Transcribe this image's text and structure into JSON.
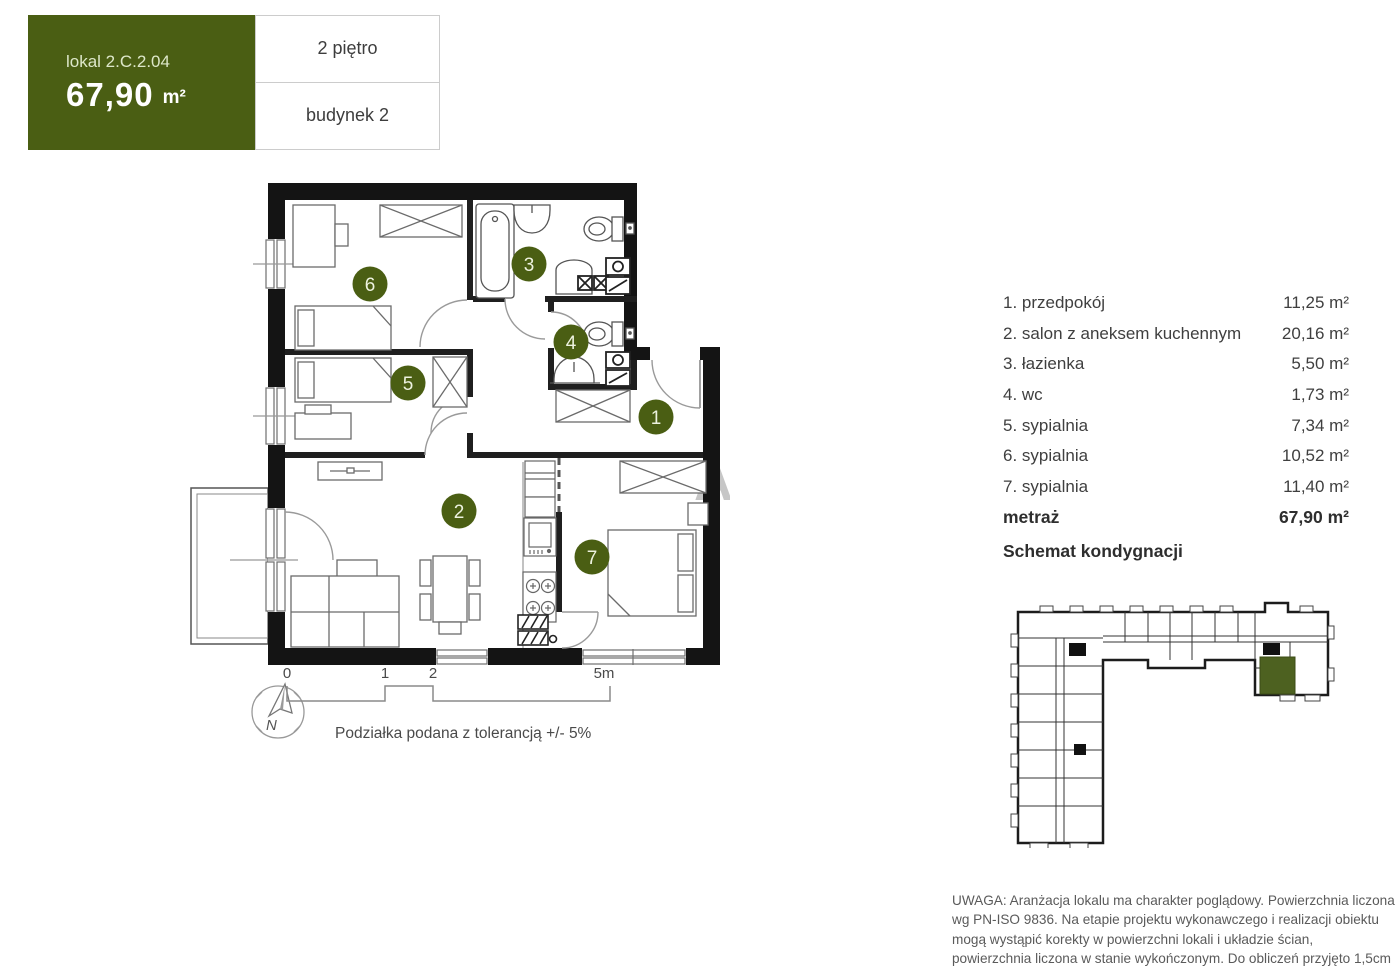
{
  "header": {
    "unit_label": "lokal 2.C.2.04",
    "area_value": "67,90",
    "area_unit": "m²",
    "floor": "2 piętro",
    "building": "budynek 2"
  },
  "colors": {
    "brand_green": "#4a5e13",
    "schematic_green": "#4d6120",
    "wall_black": "#141414"
  },
  "room_list": {
    "rows": [
      {
        "label": "1. przedpokój",
        "area": "11,25 m²"
      },
      {
        "label": "2. salon z aneksem kuchennym",
        "area": "20,16 m²"
      },
      {
        "label": "3. łazienka",
        "area": "5,50 m²"
      },
      {
        "label": "4. wc",
        "area": "1,73 m²"
      },
      {
        "label": "5. sypialnia",
        "area": "7,34 m²"
      },
      {
        "label": "6. sypialnia",
        "area": "10,52 m²"
      },
      {
        "label": "7. sypialnia",
        "area": "11,40 m²"
      }
    ],
    "total_label": "metraż",
    "total_area": "67,90 m²",
    "schematic_heading": "Schemat kondygnacji"
  },
  "plan": {
    "room_numbers": [
      "1",
      "2",
      "3",
      "4",
      "5",
      "6",
      "7"
    ],
    "watermark": "A"
  },
  "scale_bar": {
    "t0": "0",
    "t1": "1",
    "t2": "2",
    "t3": "5m",
    "note": "Podziałka podana z tolerancją +/- 5%"
  },
  "compass": {
    "label": "N"
  },
  "disclaimer": "UWAGA: Aranżacja lokalu ma charakter poglądowy. Powierzchnia liczona wg PN-ISO 9836. Na etapie projektu wykonawczego i realizacji obiektu mogą wystąpić korekty w powierzchni lokali i układzie ścian, powierzchnia liczona w stanie wykończonym. Do obliczeń przyjęto 1,5cm tynku."
}
